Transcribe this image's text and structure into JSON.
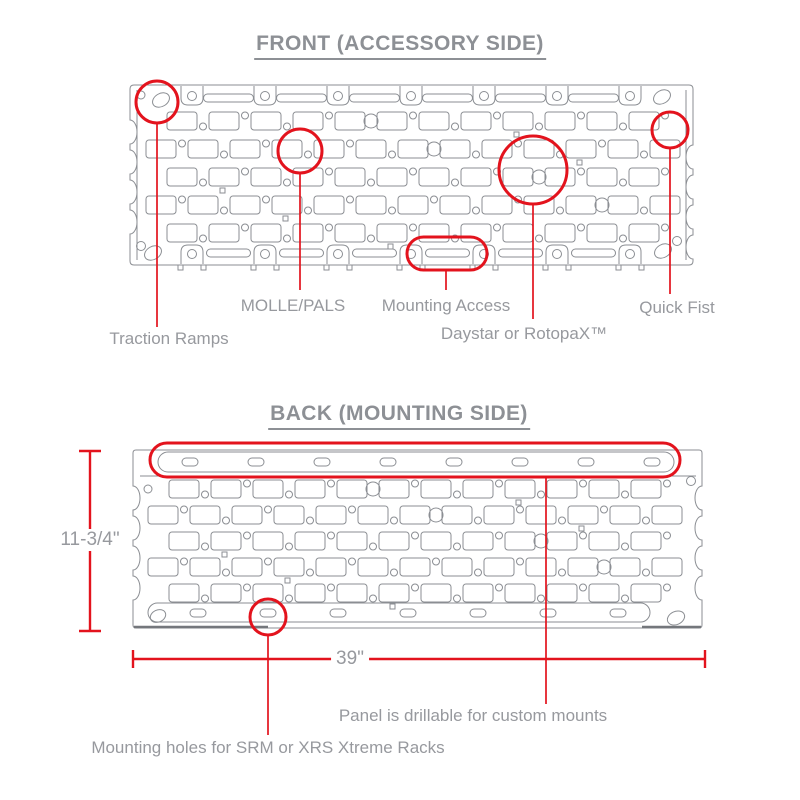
{
  "figure": {
    "front": {
      "title": "FRONT (ACCESSORY SIDE)",
      "labels": {
        "molle": "MOLLE/PALS",
        "mounting_access": "Mounting Access",
        "quick_fist": "Quick Fist",
        "traction_ramps": "Traction Ramps",
        "daystar": "Daystar or RotopaX™"
      }
    },
    "back": {
      "title": "BACK (MOUNTING SIDE)",
      "labels": {
        "drillable": "Panel is drillable for custom mounts",
        "mounting_holes": "Mounting holes for SRM or XRS Xtreme Racks"
      },
      "dimensions": {
        "height": "11-3/4\"",
        "width": "39\""
      }
    },
    "colors": {
      "annotation_red": "#e3131d",
      "panel_line": "#8b8e93",
      "panel_dark": "#74777c",
      "text_gray": "#97999e"
    }
  }
}
